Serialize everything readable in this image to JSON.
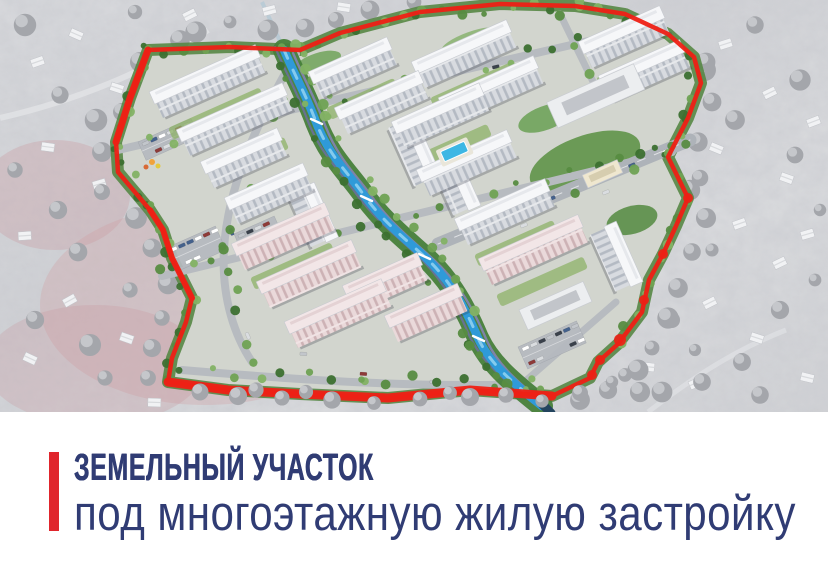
{
  "slide": {
    "title": "ЗЕМЕЛЬНЫЙ УЧАСТОК",
    "subtitle": "под многоэтажную жилую застройку"
  },
  "colors": {
    "background": "#ffffff",
    "accent-red": "#e0252c",
    "title-navy": "#303c74",
    "boundary-red": "#ee2015",
    "canal-blue": "#2f9ad8",
    "greenery": "#4d8040",
    "building-white": "#f6f7f9",
    "building-pink": "#f0dfe0",
    "snow-gray": "#d6d7da",
    "haze-pink": "#cf9aa0"
  }
}
